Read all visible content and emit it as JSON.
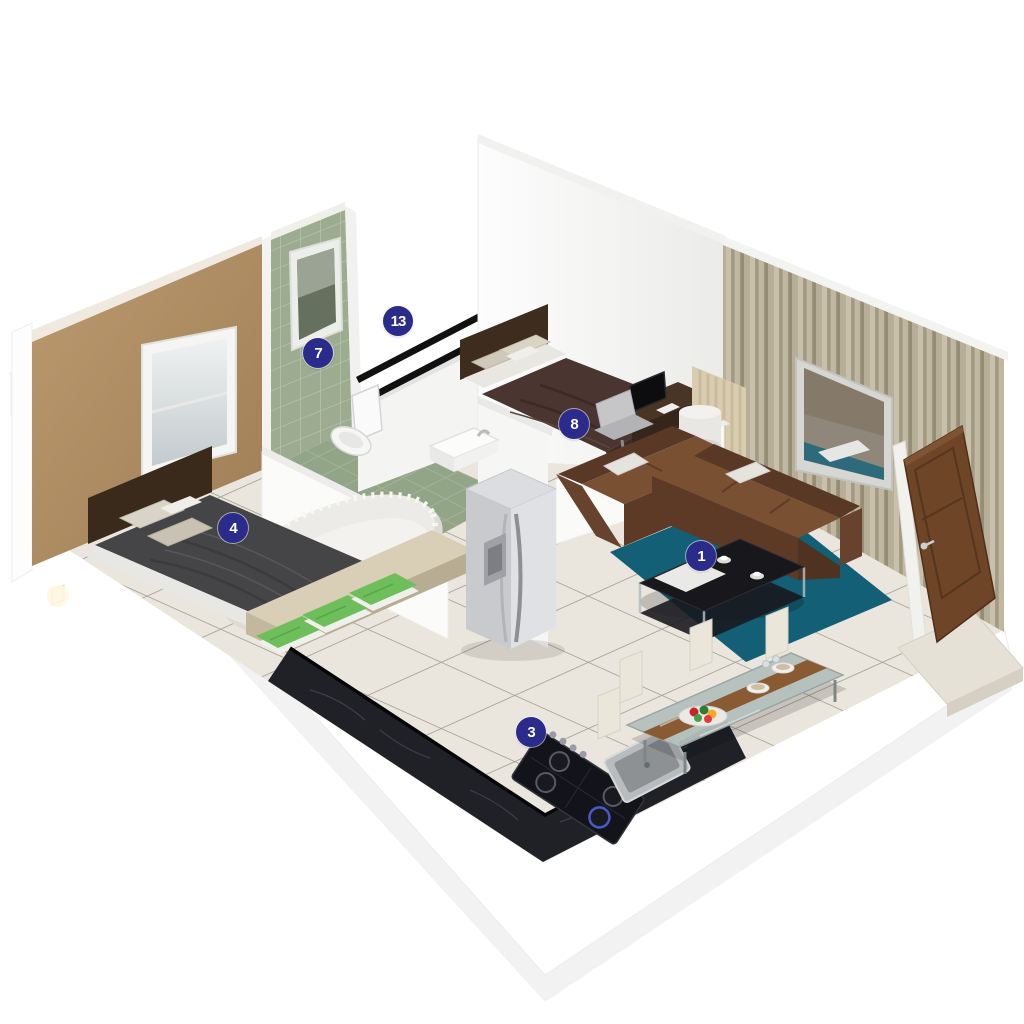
{
  "scene": {
    "description": "3D isometric rendering of a one-bedroom-plus apartment floor plan with numbered room hotspots",
    "background": "#ffffff"
  },
  "markers": [
    {
      "number": "1",
      "room": "living-room"
    },
    {
      "number": "3",
      "room": "kitchen"
    },
    {
      "number": "4",
      "room": "master-bedroom"
    },
    {
      "number": "7",
      "room": "bathroom"
    },
    {
      "number": "8",
      "room": "second-bedroom"
    },
    {
      "number": "13",
      "room": "service-shaft"
    }
  ],
  "colors": {
    "marker_bg": "#2b2b8c",
    "marker_text": "#ffffff",
    "floor_tile": "#eae6dd",
    "rug_teal": "#135f75",
    "sofa_brown": "#7a5033",
    "counter_black": "#202127",
    "bathroom_tile": "#9dac90",
    "feature_wall_tan": "#b8976c",
    "wood_wall": "#b6ae97",
    "door_brown": "#6e4526",
    "towel_green": "#6fbe5c"
  }
}
